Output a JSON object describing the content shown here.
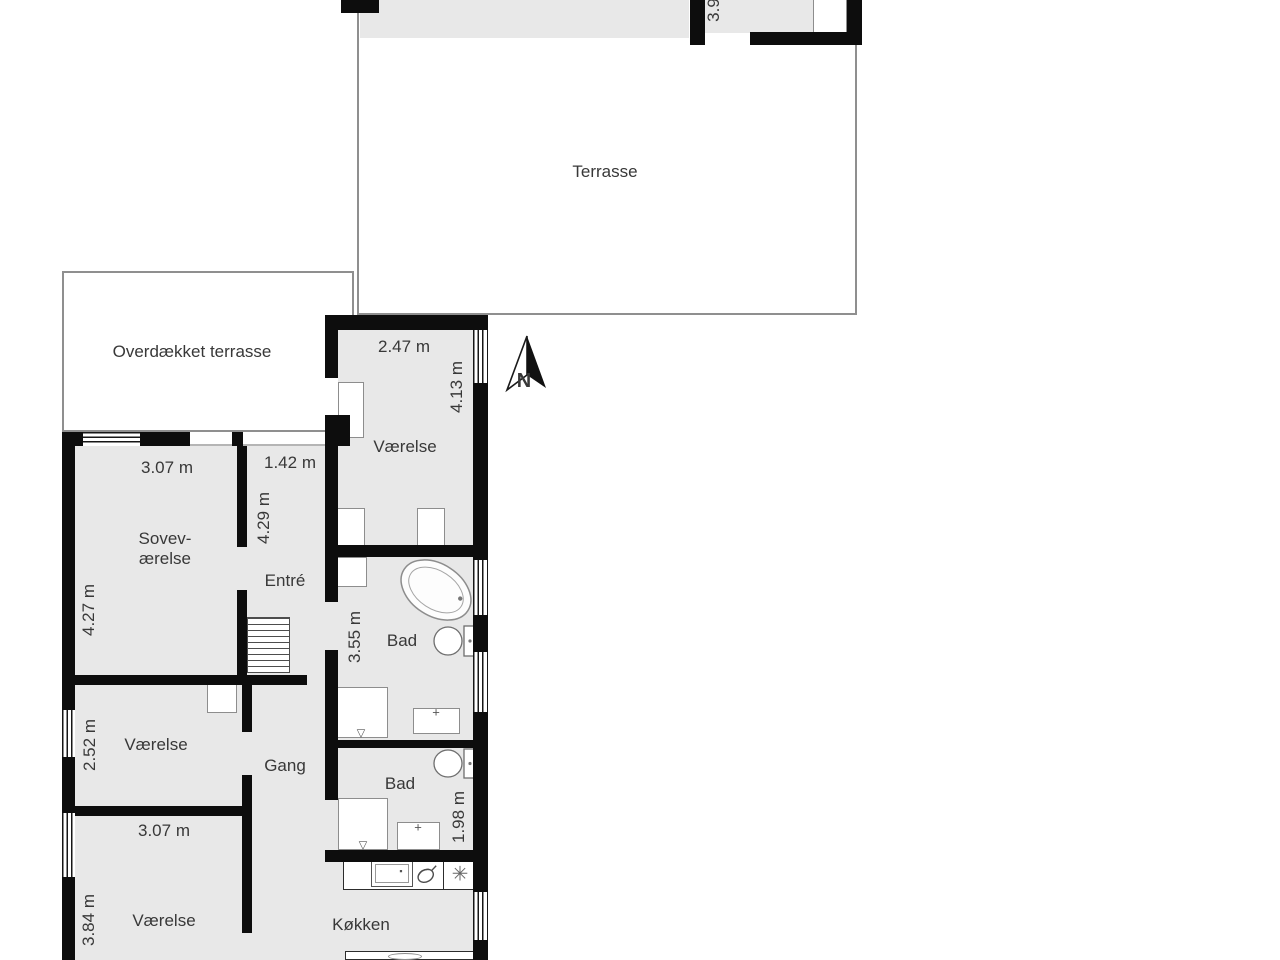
{
  "colors": {
    "wall": "#0d0d0d",
    "room_fill": "#e8e8e8",
    "outdoor_border": "#8f8f8f",
    "text": "#383838"
  },
  "compass": {
    "label": "N"
  },
  "rooms": {
    "terrasse": {
      "label": "Terrasse"
    },
    "overdaekket_terrasse": {
      "label": "Overdækket terrasse"
    },
    "vaerelse_ne": {
      "label": "Værelse",
      "width": "2.47 m",
      "depth": "4.13 m"
    },
    "sovevaerelse": {
      "label_line1": "Sovev-",
      "label_line2": "ærelse",
      "width": "3.07 m",
      "depth": "4.27 m"
    },
    "entre": {
      "label": "Entré",
      "width": "1.42 m",
      "depth": "4.29 m"
    },
    "bad_1": {
      "label": "Bad",
      "depth": "3.55 m"
    },
    "gang": {
      "label": "Gang"
    },
    "vaerelse_mid": {
      "label": "Værelse",
      "depth": "2.52 m"
    },
    "bad_2": {
      "label": "Bad",
      "depth": "1.98 m"
    },
    "vaerelse_sw": {
      "label": "Værelse",
      "width": "3.07 m",
      "depth": "3.84 m"
    },
    "koekken": {
      "label": "Køkken"
    },
    "room_top_partial": {
      "dim": "3.9"
    }
  },
  "fixtures": {
    "shower_drain": "▽",
    "sink_tap": "+",
    "hob_symbol": "✳"
  }
}
